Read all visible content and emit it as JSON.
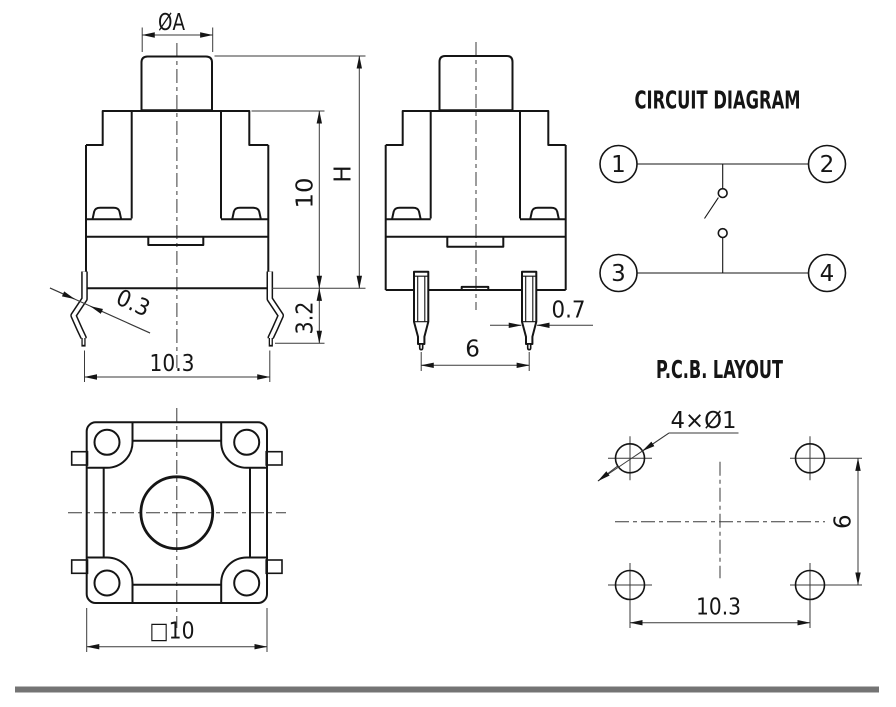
{
  "titles": {
    "circuit_diagram": "CIRCUIT DIAGRAM",
    "pcb_layout": "P.C.B. LAYOUT"
  },
  "front_view": {
    "cap_diameter": "ØA",
    "body_height": "10",
    "total_height": "H",
    "lead_length": "3.2",
    "lead_thickness": "0.3",
    "lead_span": "10.3"
  },
  "side_view": {
    "pin_width": "0.7",
    "pin_pitch": "6"
  },
  "top_view": {
    "body_size": "□10"
  },
  "circuit_diagram": {
    "pins": [
      "1",
      "2",
      "3",
      "4"
    ]
  },
  "pcb_layout": {
    "hole_callout": "4×Ø1",
    "vertical_pitch": "6",
    "horizontal_pitch": "10.3"
  }
}
